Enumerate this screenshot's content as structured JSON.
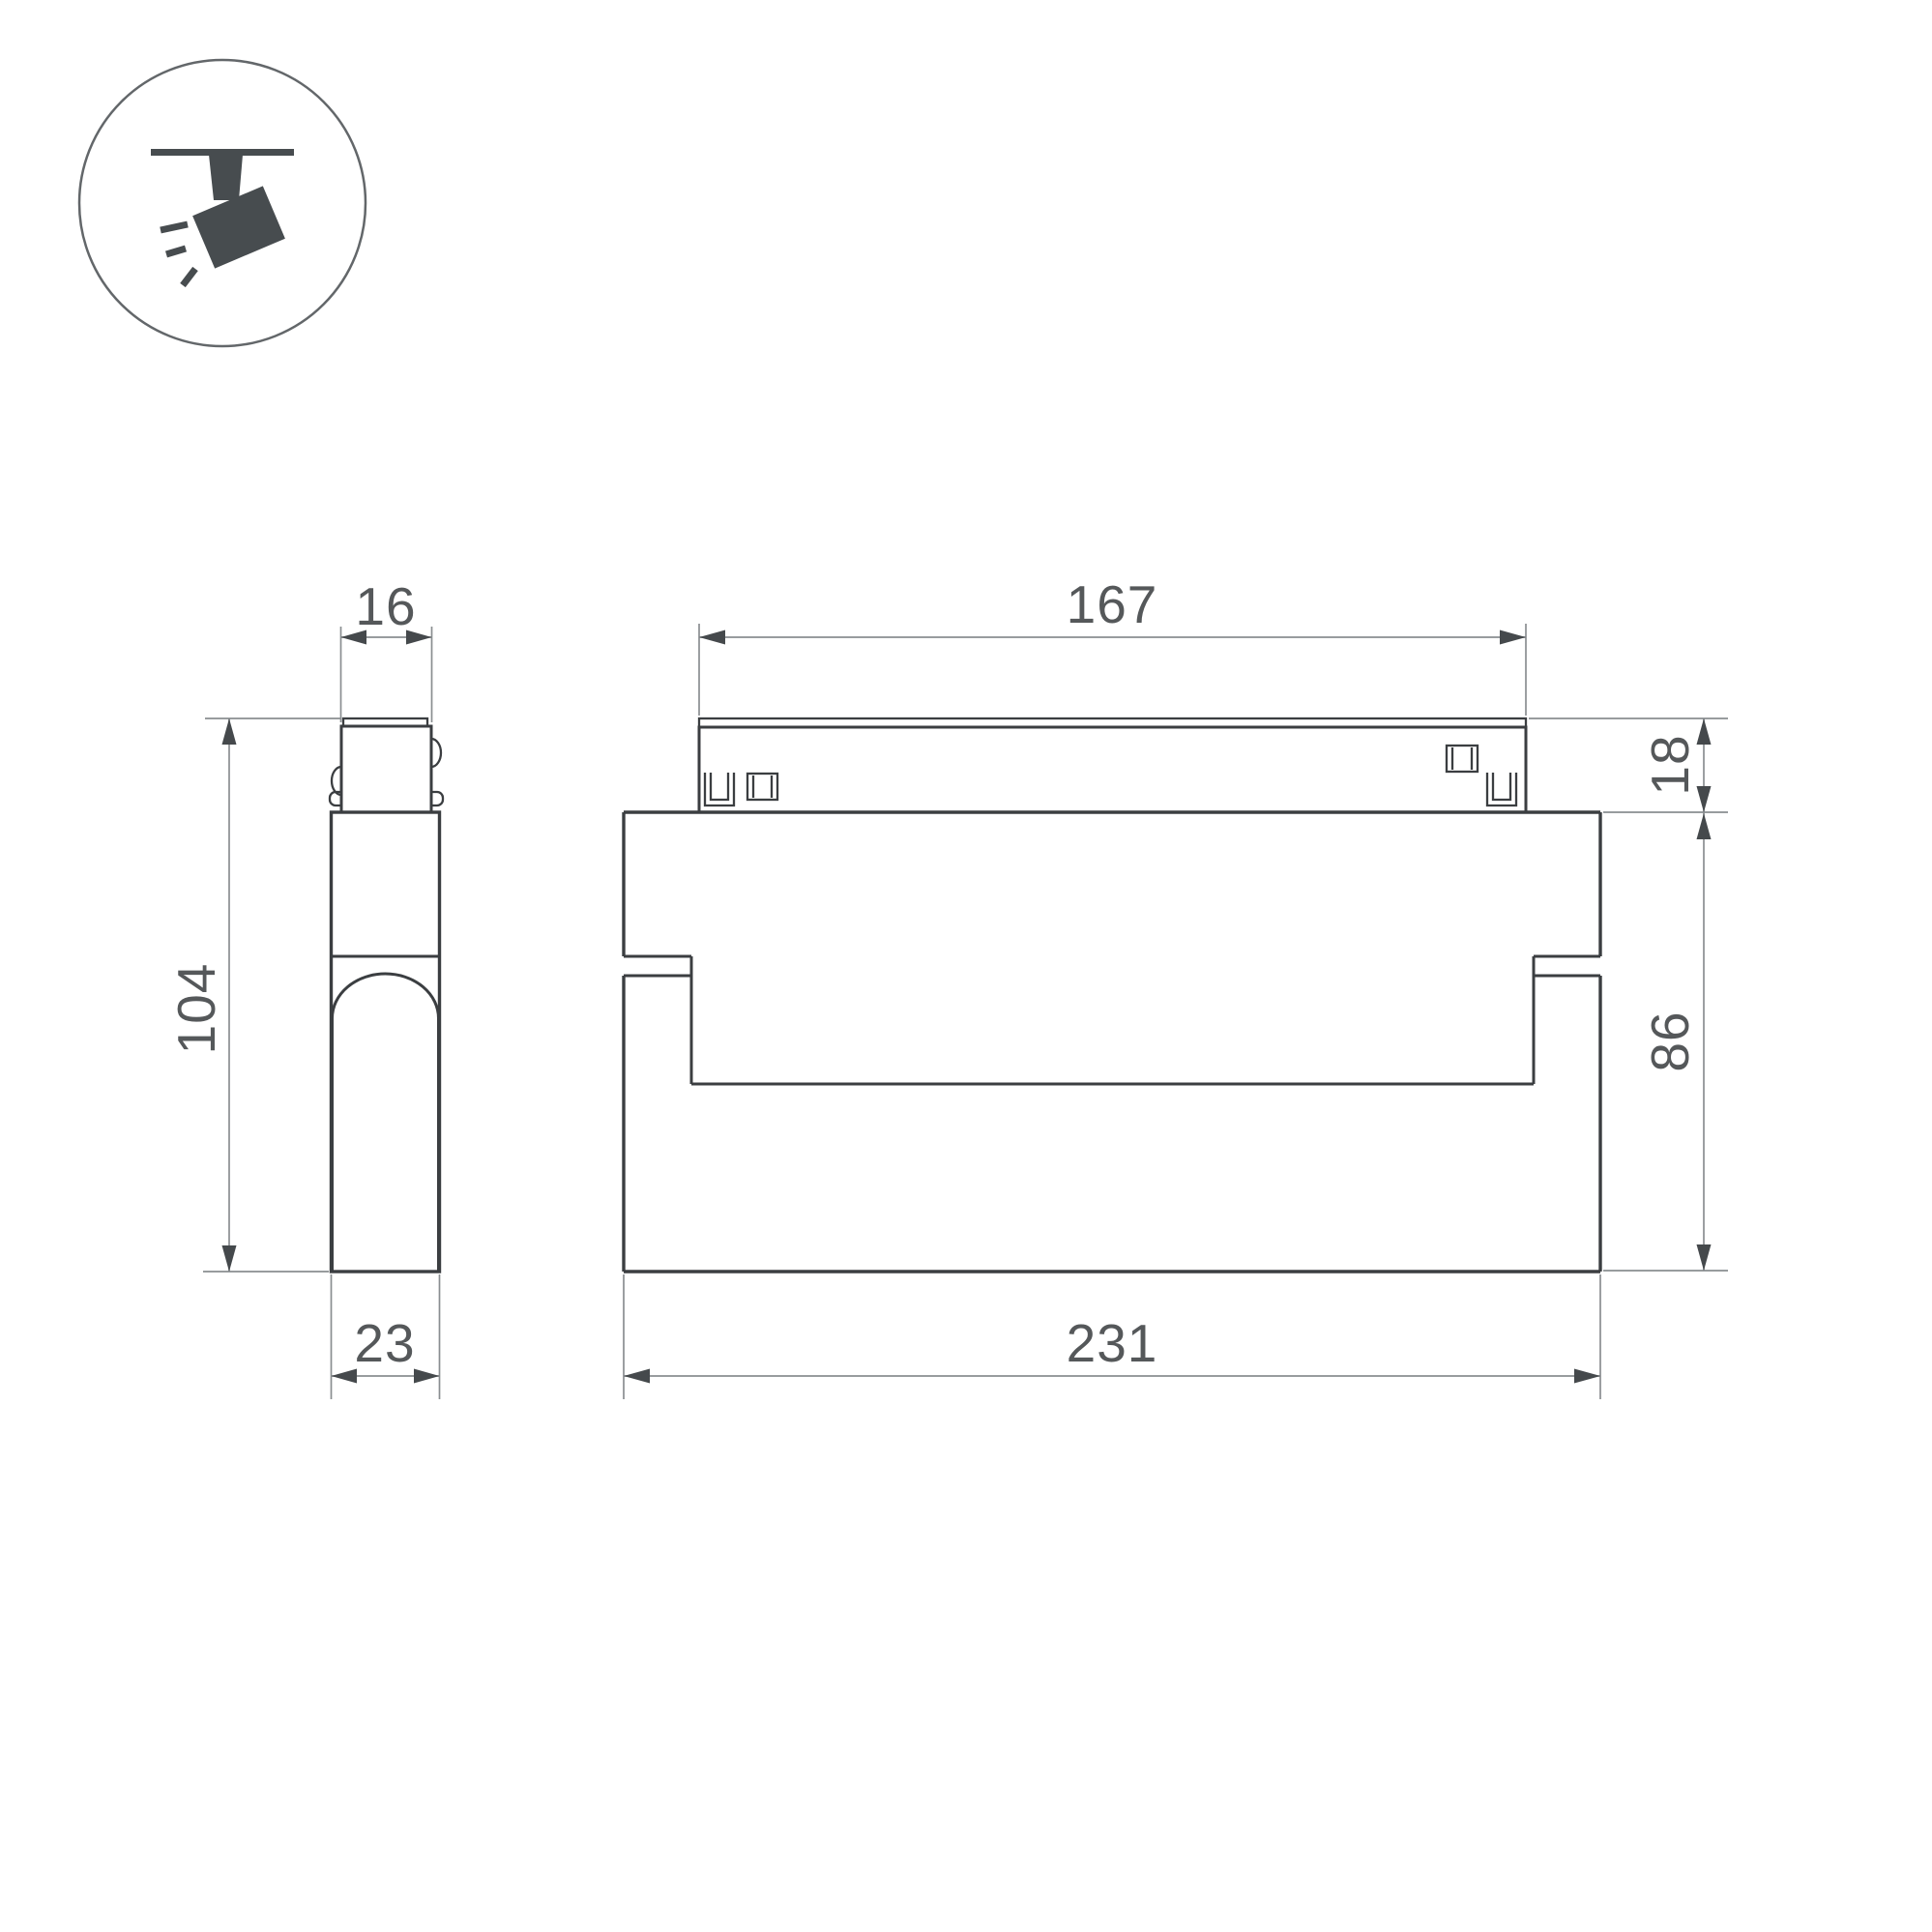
{
  "drawing": {
    "kind": "technical-dimension-drawing",
    "icon": {
      "name": "track-spotlight-icon"
    },
    "dims": {
      "side_width_top": "16",
      "side_height": "104",
      "side_depth": "23",
      "front_track_width": "167",
      "front_track_height": "18",
      "front_body_height": "86",
      "front_total_width": "231"
    },
    "colors": {
      "outline": "#3b3e41",
      "dimension_lines": "#8a8e91",
      "dimension_text": "#55585a",
      "icon": "#474c4f",
      "background": "#ffffff"
    }
  }
}
